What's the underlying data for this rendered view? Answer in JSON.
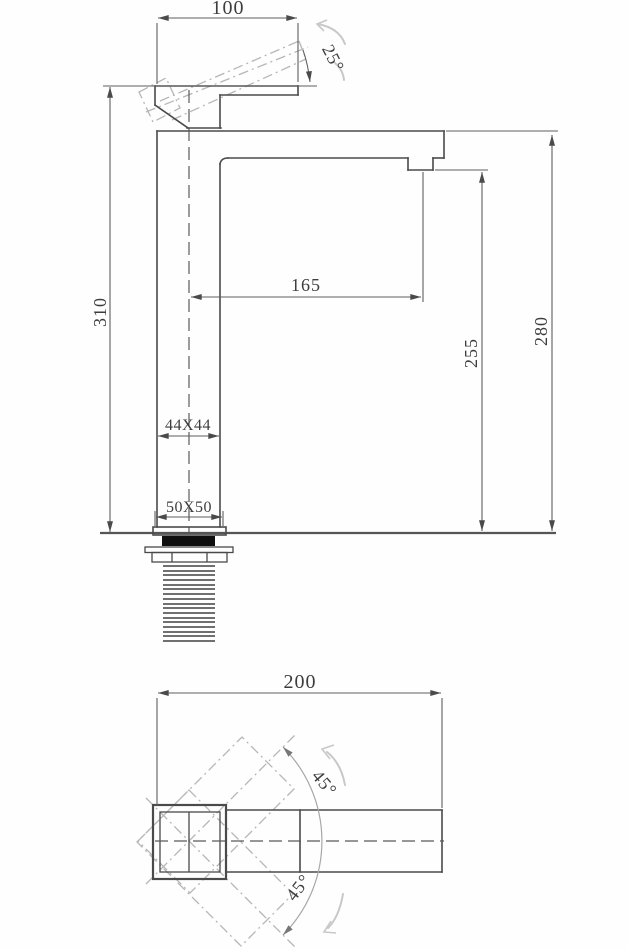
{
  "side_view": {
    "top_width": "100",
    "handle_angle": "25°",
    "total_height": "310",
    "spout_reach": "165",
    "aerator_height": "255",
    "spout_top_height": "280",
    "body_section": "44X44",
    "base_section": "50X50"
  },
  "plan_view": {
    "overall_length": "200",
    "handle_swing_up": "45°",
    "handle_swing_down": "45°"
  },
  "colors": {
    "geometry_line": "#4a4a4a",
    "dimension_line": "#5e5e5e",
    "phantom_line": "#b6b6b6",
    "rotation_hint": "#c8c8c8",
    "gasket_fill": "#0f0f0f",
    "background": "#fefefe"
  }
}
